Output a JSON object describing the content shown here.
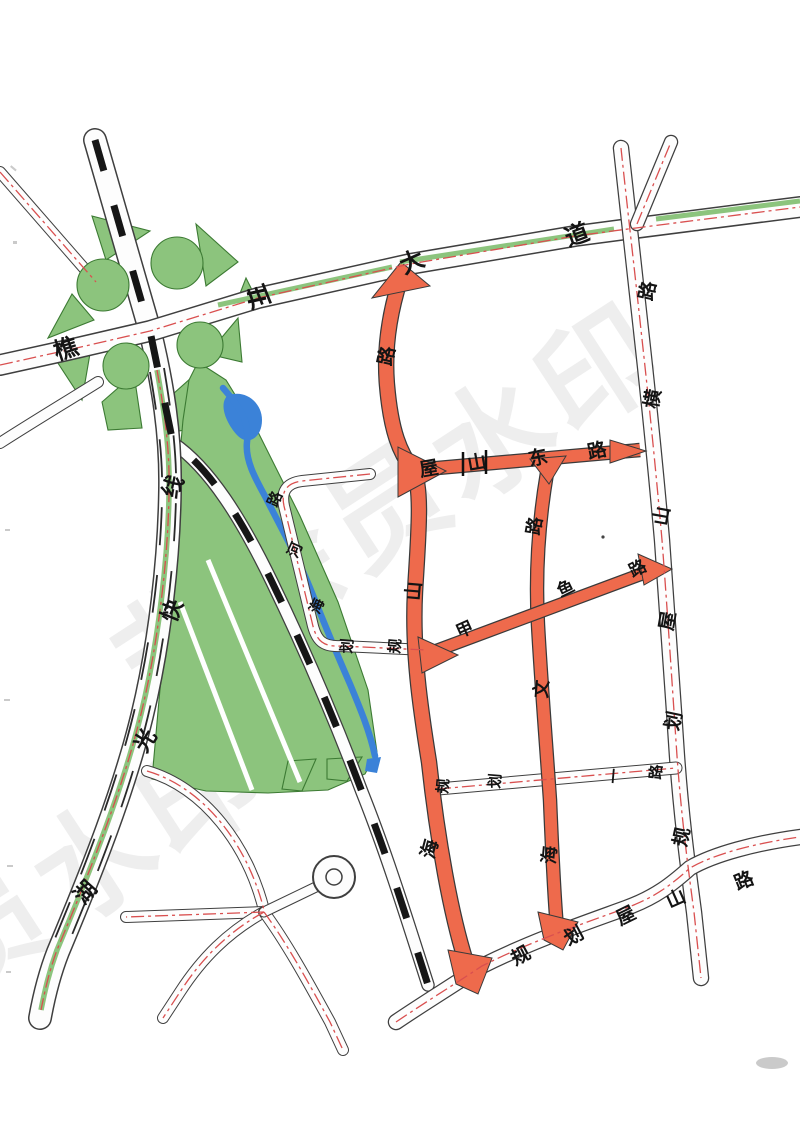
{
  "map": {
    "type": "scanned-urban-planning-road-map",
    "language": "zh-CN",
    "colors": {
      "road_casing": "#3f3f3f",
      "road_fill": "#fdfdfd",
      "planned_red_road": "#ee6a4c",
      "red_road_casing": "#3a3a3a",
      "green_area": "#8cc47d",
      "green_outline": "#3c7a33",
      "water": "#3b82d8",
      "centerline_red": "#d94f4f",
      "railway_black": "#161616",
      "label_black": "#141414",
      "watermark_gray": "#9a9a9a"
    },
    "watermark": {
      "text": "非会员水印",
      "size": 118,
      "angle": -33,
      "opacity": 0.16,
      "instances": [
        {
          "x": 148,
          "y": 712
        },
        {
          "x": -250,
          "y": 1135
        }
      ]
    },
    "features": {
      "interchange": "cloverleaf-interchange-top-left",
      "railway": "black-dashed-rail-line-diagonal",
      "river": "blue-stream-through-green-belt",
      "roundabout": "small-roundabout-bottom-left"
    },
    "roads": [
      {
        "id": "qiaochuan-avenue",
        "name": "樵川大道",
        "style": "arterial-with-green-median",
        "label_size": 24,
        "labels": [
          [
            "樵",
            66,
            349,
            -18
          ],
          [
            "川",
            259,
            297,
            -22
          ],
          [
            "大",
            412,
            262,
            -24
          ],
          [
            "道",
            577,
            235,
            -20
          ]
        ]
      },
      {
        "id": "huguang-expressline",
        "name": "湖光快线",
        "style": "expressway-with-green-median",
        "label_size": 22,
        "labels": [
          [
            "湖",
            86,
            893,
            -48
          ],
          [
            "光",
            146,
            741,
            -58
          ],
          [
            "快",
            173,
            611,
            -68
          ],
          [
            "线",
            174,
            487,
            -68
          ]
        ]
      },
      {
        "id": "guihua-wushan-heng-road",
        "name": "规划屋山横路",
        "style": "secondary",
        "label_size": 19,
        "labels": [
          [
            "规",
            682,
            837,
            -78
          ],
          [
            "划",
            674,
            721,
            -78
          ],
          [
            "屋",
            668,
            621,
            -80
          ],
          [
            "山",
            662,
            516,
            -80
          ],
          [
            "横",
            653,
            399,
            -80
          ],
          [
            "路",
            648,
            291,
            -78
          ]
        ]
      },
      {
        "id": "guihua-wushan-road",
        "name": "规划屋山路",
        "style": "secondary",
        "label_size": 19,
        "labels": [
          [
            "规",
            521,
            956,
            -28
          ],
          [
            "划",
            574,
            936,
            -28
          ],
          [
            "屋",
            626,
            916,
            -26
          ],
          [
            "山",
            676,
            899,
            -24
          ],
          [
            "路",
            744,
            881,
            -22
          ]
        ]
      },
      {
        "id": "haishan-road",
        "name": "海山路",
        "style": "planned-red",
        "label_size": 19,
        "labels": [
          [
            "海",
            430,
            849,
            -75
          ],
          [
            "山",
            414,
            591,
            -85
          ],
          [
            "路",
            387,
            356,
            -78
          ]
        ]
      },
      {
        "id": "wushan-east-road",
        "name": "屋山东路",
        "style": "planned-red",
        "label_size": 19,
        "labels": [
          [
            "屋",
            429,
            469,
            -10
          ],
          [
            "山",
            477,
            463,
            -10
          ],
          [
            "东",
            538,
            458,
            -12
          ],
          [
            "路",
            597,
            451,
            -12
          ]
        ]
      },
      {
        "id": "haiwen-road",
        "name": "海文路",
        "style": "planned-red",
        "label_size": 18,
        "labels": [
          [
            "海",
            550,
            855,
            -85
          ],
          [
            "文",
            542,
            689,
            -85
          ],
          [
            "路",
            535,
            526,
            -80
          ]
        ]
      },
      {
        "id": "jiayu-road",
        "name": "甲鱼路",
        "style": "planned-red",
        "label_size": 17,
        "labels": [
          [
            "甲",
            465,
            630,
            -24
          ],
          [
            "鱼",
            566,
            589,
            -26
          ],
          [
            "路",
            638,
            569,
            -26
          ]
        ]
      },
      {
        "id": "haihe-road",
        "name": "海河路",
        "style": "local-loop",
        "label_size": 15,
        "labels": [
          [
            "海",
            317,
            606,
            -66
          ],
          [
            "河",
            295,
            550,
            -66
          ],
          [
            "路",
            275,
            499,
            -66
          ]
        ]
      },
      {
        "id": "guihua-loop-south",
        "name": "规划",
        "style": "local-loop",
        "label_size": 15,
        "labels": [
          [
            "规",
            395,
            646,
            -85
          ],
          [
            "划",
            347,
            646,
            -85
          ]
        ]
      },
      {
        "id": "guihua-yi-road",
        "name": "规划一路",
        "style": "local",
        "label_size": 15,
        "labels": [
          [
            "规",
            443,
            786,
            -85
          ],
          [
            "划",
            495,
            781,
            -85
          ],
          [
            "一",
            614,
            776,
            -85
          ],
          [
            "路",
            656,
            772,
            -85
          ]
        ]
      }
    ]
  }
}
